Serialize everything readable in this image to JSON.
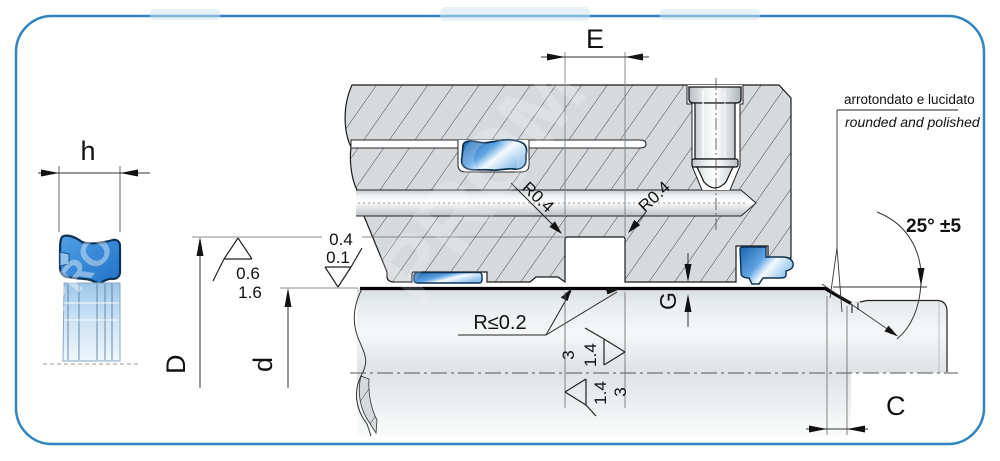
{
  "left_figure": {
    "height_label": "h"
  },
  "dimensions": {
    "groove_width": "E",
    "groove_diameter": "D",
    "rod_diameter": "d",
    "chamfer_length": "C",
    "gap_height": "G"
  },
  "radii": {
    "groove_corner_left": "R0.4",
    "groove_corner_right": "R0.4",
    "edge_radius": "R≤0.2"
  },
  "surface_marks": {
    "rod_line_top": "0.4",
    "rod_line_bottom": "0.1",
    "groove_line_top": "0.6",
    "groove_line_bottom": "1.6",
    "flank_right_outer": "3",
    "flank_right_inner": "1.4",
    "flank_left_inner": "1.4",
    "flank_left_outer": "3"
  },
  "chamfer": {
    "angle": "25° ±5"
  },
  "note": {
    "it": "arrotondato e lucidato",
    "en": "rounded and polished"
  },
  "watermark": {
    "brand_fragment_main": "PROM",
    "brand_fragment_seal": "PRO"
  },
  "colors": {
    "border_blue": "#2f86bf",
    "seal_blue": "#2e7fd2",
    "metal_gray": "#d7dadd",
    "line_black": "#111111"
  }
}
